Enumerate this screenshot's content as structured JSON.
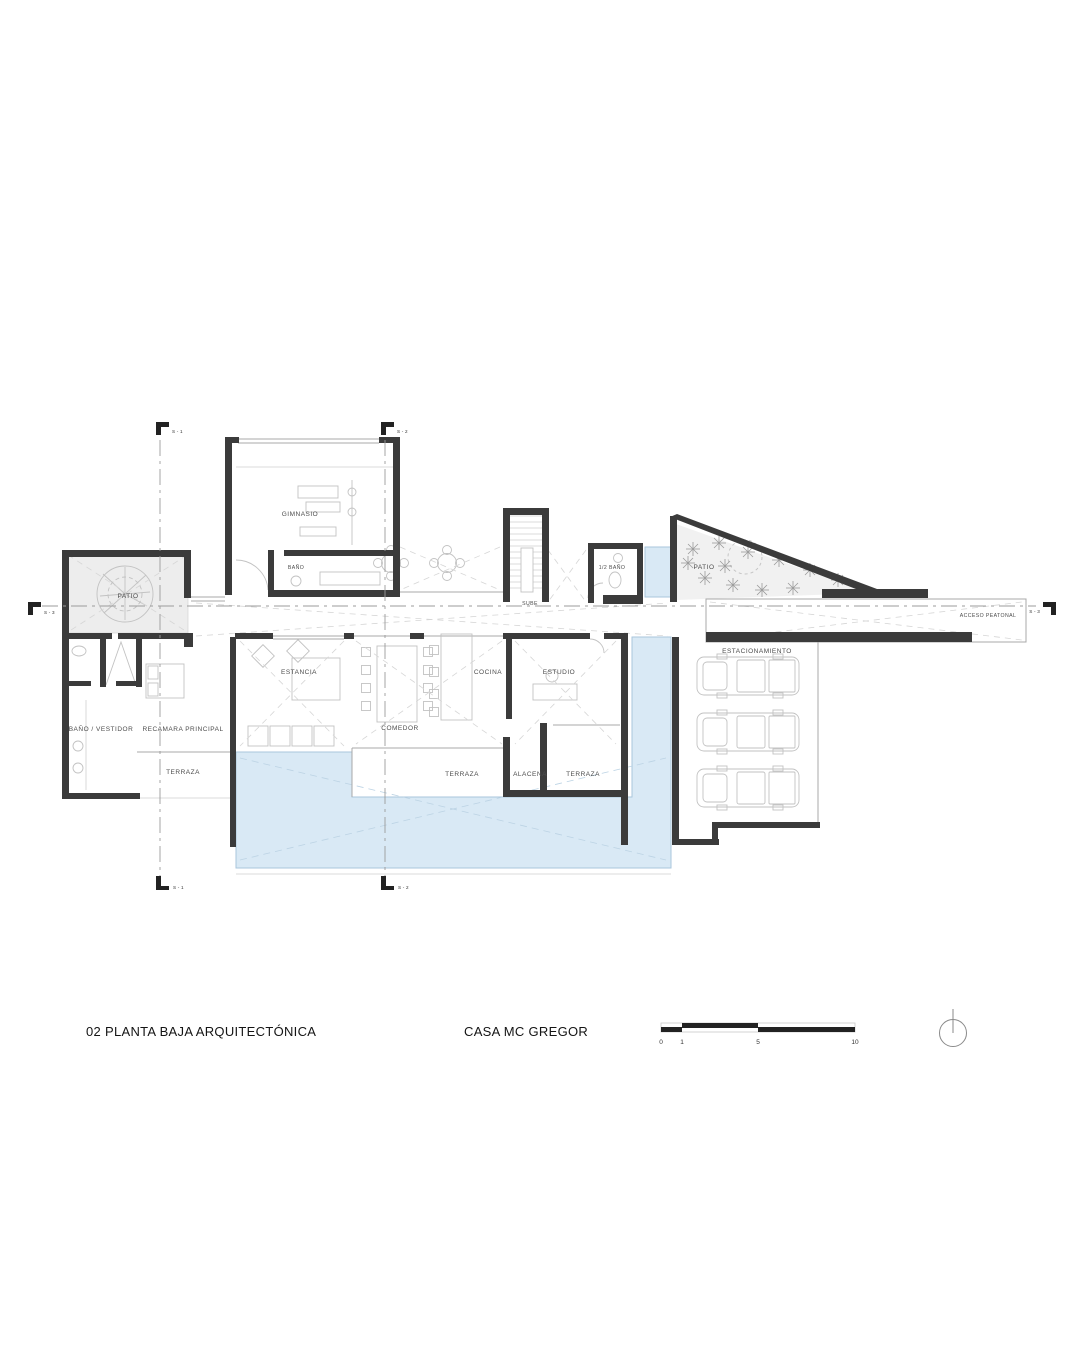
{
  "drawing": {
    "title": "02 PLANTA BAJA ARQUITECTÓNICA",
    "project": "CASA MC GREGOR"
  },
  "rooms": {
    "patio_izquierdo": "PATIO",
    "gimnasio": "GIMNASIO",
    "banio_gimnasio": "BAÑO",
    "escalera": "SUBE",
    "medio_banio": "1/2 BAÑO",
    "patio_acceso": "PATIO",
    "acceso_peatonal": "ACCESO PEATONAL",
    "estacionamiento": "ESTACIONAMIENTO",
    "banio_vestidor": "BAÑO / VESTIDOR",
    "recamara_principal": "RECAMARA PRINCIPAL",
    "terraza_poniente": "TERRAZA",
    "estancia": "ESTANCIA",
    "comedor": "COMEDOR",
    "cocina": "COCINA",
    "estudio": "ESTUDIO",
    "terraza_central": "TERRAZA",
    "alacena": "ALACENA",
    "terraza_oriente": "TERRAZA"
  },
  "sections": {
    "s1": "S - 1",
    "s2": "S - 2",
    "s3": "S - 3"
  },
  "scale_bar": {
    "ticks": [
      "0",
      "1",
      "5",
      "10"
    ]
  },
  "colors": {
    "wall": "#3b3b3b",
    "pool_fill": "#d9e9f5",
    "pool_edge": "#a9c6dc",
    "patio_fill": "#ededed",
    "sketch": "#c2c2c2",
    "label": "#4c4c4c"
  }
}
